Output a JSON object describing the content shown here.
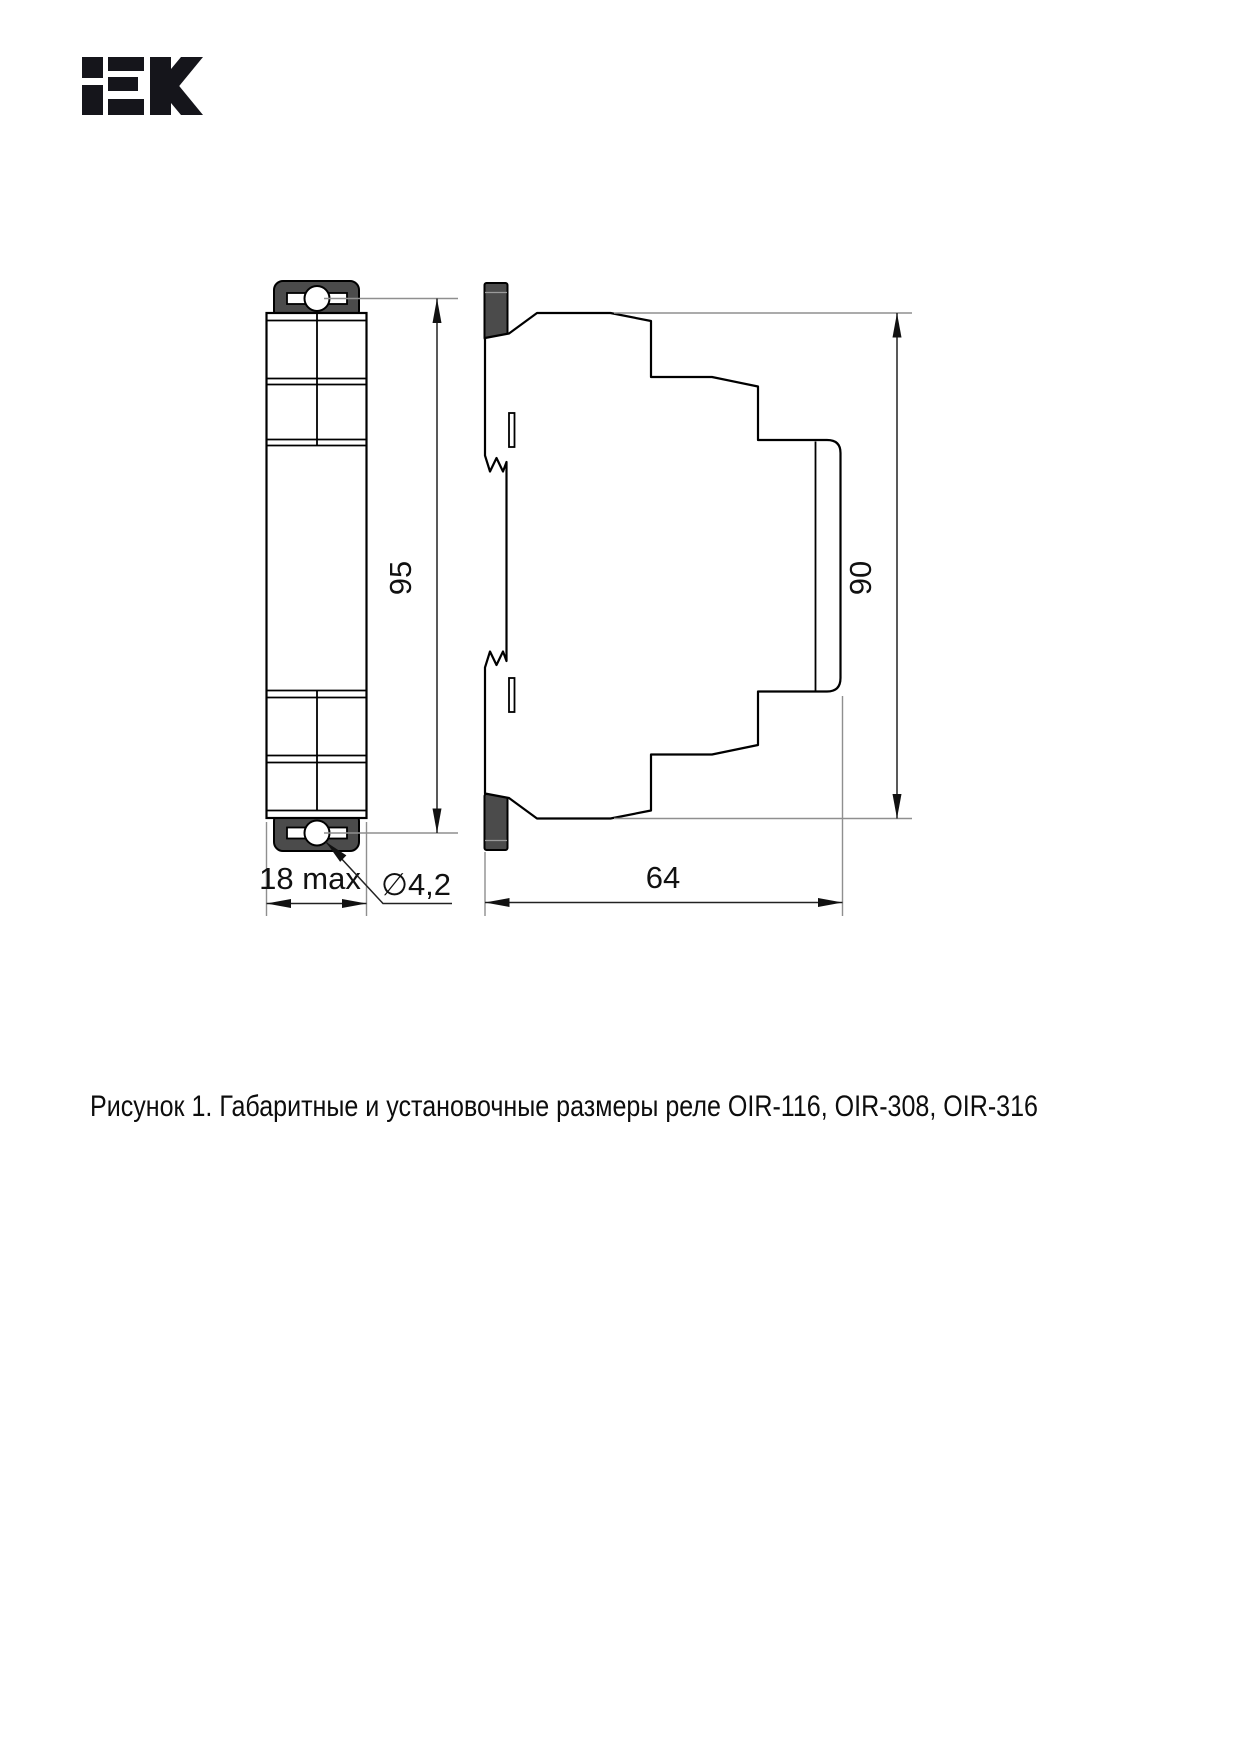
{
  "page": {
    "background": "#ffffff",
    "logo": {
      "text": "IEK",
      "color": "#15151b"
    },
    "caption": "Рисунок 1. Габаритные и установочные размеры реле OIR-116, OIR-308, OIR-316"
  },
  "drawing": {
    "type": "technical-dimension-drawing",
    "views": {
      "front": {
        "name": "front view (DIN relay module)",
        "height_mm": "95",
        "width_mm": "18 max",
        "mount_hole_diameter": "∅4,2"
      },
      "side": {
        "name": "side view (DIN relay module)",
        "height_mm": "90",
        "depth_mm": "64"
      }
    },
    "colors": {
      "outline": "#000000",
      "mount_tab_fill": "#4b4b4b",
      "dimension_line": "#222222",
      "extension_line": "#8f8f8f"
    }
  }
}
